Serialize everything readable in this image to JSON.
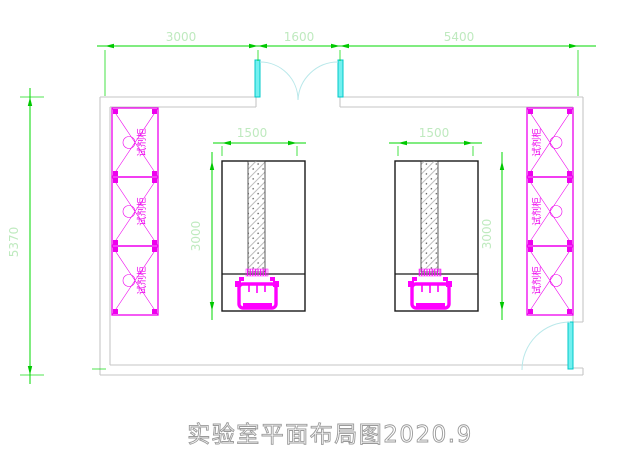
{
  "title": "实验室平面布局图2020.9",
  "dims": {
    "top": [
      "3000",
      "1600",
      "5400"
    ],
    "left": "5370",
    "bench_width": [
      "1500",
      "1500"
    ],
    "bench_depth": [
      "3000",
      "3000"
    ]
  },
  "cabinets": {
    "left": [
      "试剂柜",
      "试剂柜",
      "试剂柜"
    ],
    "right": [
      "试剂柜",
      "试剂柜",
      "试剂柜"
    ]
  },
  "icons": {
    "bench_duct": "hatched-duct-icon",
    "sink": "sink-icon",
    "cabinet_cross": "cross-brace-icon",
    "door": "door-swing-icon"
  },
  "colors": {
    "dimension_line": "#00d900",
    "dimension_text": "#bfeabf",
    "cabinet": "#ee00ee",
    "equipment": "#ff00ff",
    "door_leaf": "#74f0f0",
    "door_arc": "#b9e8ea",
    "wall": "#c6c6c6",
    "bench_outline": "#1a1a1a",
    "title_text": "#9a9a9a"
  }
}
